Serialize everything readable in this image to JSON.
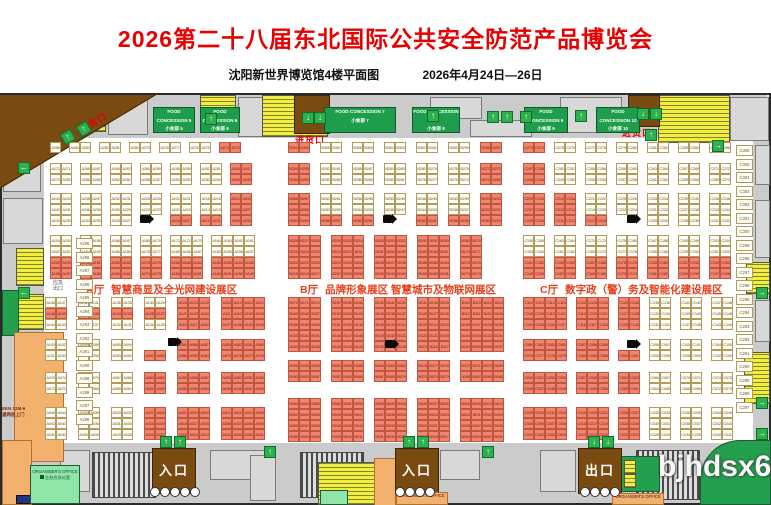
{
  "header": {
    "title": "2026第二十八届东北国际公共安全防范产品博览会",
    "venue": "沈阳新世界博览馆4楼平面图",
    "dates": "2026年4月24日—26日"
  },
  "watermark": "bjhdsx6.c",
  "zones": [
    {
      "label": "A厅",
      "name": "智慧商显及全光网建设展区"
    },
    {
      "label": "B厅",
      "name": "品牌形象展区  智慧城市及物联网展区"
    },
    {
      "label": "C厅",
      "name": "数字政（警）务及智能化建设展区"
    }
  ],
  "labels": {
    "delivery": "进货口",
    "entrance": "入口",
    "exit": "出口",
    "emergency": "应急\n出口",
    "office_en": "ORGANISER'S OFFICE",
    "office_cn": "主办方办公室",
    "left_note": "EEN 12M-6\n通两层上门"
  },
  "food_concessions": [
    {
      "en": "FOOD CONCESSION 5",
      "cn": "小食部 5"
    },
    {
      "en": "FOOD CONCESSION 6",
      "cn": "小食部 6"
    },
    {
      "en": "FOOD CONCESSION 7",
      "cn": "小食部 7"
    },
    {
      "en": "FOOD CONCESSION 8",
      "cn": "小食部 8"
    },
    {
      "en": "FOOD CONCESSION 9",
      "cn": "小食部 9"
    },
    {
      "en": "FOOD CONCESSION 10",
      "cn": "小食部 10"
    }
  ],
  "colors": {
    "pink": "#F08570",
    "cell": "#FFFEF6",
    "zone": "#E8401C",
    "title": "#E60000",
    "dock": "#7A4B10",
    "green": "#1E9E4C",
    "yellow": "#F2EE3E",
    "corridor": "#CBCBCB"
  },
  "halls": {
    "A": {
      "prefix": "A",
      "dir": "desc",
      "x": 50,
      "gap": 8,
      "x2": 45,
      "gap2": 11,
      "column": {
        "x": 76,
        "y": 238,
        "start": 299,
        "count": 14
      },
      "bands": [
        {
          "y": 142,
          "rows": 1,
          "lo": true,
          "blocks": [
            {
              "c": 1,
              "s": 285
            },
            {
              "c": 2,
              "s": 284
            },
            {
              "c": 2,
              "s": 282
            },
            {
              "c": 2,
              "s": 280
            },
            {
              "c": 2,
              "s": 278
            },
            {
              "c": 2,
              "s": 276
            },
            {
              "c": 2,
              "s": 274,
              "p": 1
            }
          ]
        },
        {
          "y": 163,
          "rows": 2,
          "lo": true,
          "blocks": [
            {
              "c": 2,
              "s": 272
            },
            {
              "c": 2,
              "s": 268
            },
            {
              "c": 2,
              "s": 264
            },
            {
              "c": 2,
              "s": 260
            },
            {
              "c": 2,
              "s": 256
            },
            {
              "c": 2,
              "s": 252
            },
            {
              "c": 2,
              "s": 248,
              "p": 1
            }
          ]
        },
        {
          "y": 193,
          "rows": 3,
          "lo": true,
          "blocks": [
            {
              "c": 2,
              "s": 244
            },
            {
              "c": 2,
              "s": 238
            },
            {
              "c": 2,
              "s": 232
            },
            {
              "c": 2,
              "s": 226,
              "r": 2
            },
            {
              "c": 2,
              "s": 222,
              "p": 2
            },
            {
              "c": 2,
              "s": 216,
              "p": 2
            },
            {
              "c": 2,
              "s": 210,
              "p": 1
            }
          ]
        },
        {
          "y": 235,
          "rows": 4,
          "lo": true,
          "blocks": [
            {
              "c": 2,
              "s": 204,
              "p": 2
            },
            {
              "c": 2,
              "s": 196,
              "p": 2
            },
            {
              "c": 2,
              "s": 188,
              "p": 2
            },
            {
              "c": 2,
              "s": 180,
              "p": 2
            },
            {
              "c": 3,
              "s": 172,
              "p": 2
            },
            {
              "c": 4,
              "s": 164,
              "p": 2
            }
          ]
        },
        {
          "y": 297,
          "rows": 3,
          "blocks": [
            {
              "c": 2,
              "s": 148,
              "p": 3
            },
            {
              "c": 2,
              "s": 142,
              "p": 3
            },
            {
              "c": 2,
              "s": 136,
              "p": 3
            },
            {
              "c": 2,
              "s": 130,
              "p": 3
            },
            {
              "c": 3,
              "s": 124,
              "p": 1
            },
            {
              "c": 4,
              "s": 115,
              "p": 1
            }
          ]
        },
        {
          "y": 339,
          "rows": 2,
          "blocks": [
            {
              "c": 2,
              "s": 103
            },
            {
              "c": 2,
              "s": 99
            },
            {
              "c": 2,
              "s": 95
            },
            {
              "c": 2,
              "s": 91,
              "p": 1,
              "r": 1,
              "va": "b"
            },
            {
              "c": 3,
              "s": 89,
              "p": 1
            },
            {
              "c": 4,
              "s": 83,
              "p": 1
            }
          ]
        },
        {
          "y": 372,
          "rows": 2,
          "blocks": [
            {
              "c": 2,
              "s": 75
            },
            {
              "c": 2,
              "s": 71
            },
            {
              "c": 2,
              "s": 67
            },
            {
              "c": 2,
              "s": 63,
              "p": 1
            },
            {
              "c": 3,
              "s": 59,
              "p": 1
            },
            {
              "c": 4,
              "s": 53,
              "p": 1
            }
          ]
        },
        {
          "y": 407,
          "rows": 3,
          "blocks": [
            {
              "c": 2,
              "s": 45
            },
            {
              "c": 2,
              "s": 39
            },
            {
              "c": 2,
              "s": 33
            },
            {
              "c": 2,
              "s": 27,
              "p": 1
            },
            {
              "c": 3,
              "s": 21,
              "p": 1
            },
            {
              "c": 4,
              "s": 12,
              "p": 1
            }
          ]
        }
      ]
    },
    "B": {
      "prefix": "B",
      "dir": "desc",
      "x": 288,
      "gap": 10,
      "x2": 288,
      "gap2": 10,
      "bands": [
        {
          "y": 142,
          "rows": 1,
          "lo": true,
          "blocks": [
            {
              "c": 2,
              "s": 310,
              "p": 1
            },
            {
              "c": 2,
              "s": 308
            },
            {
              "c": 2,
              "s": 306
            },
            {
              "c": 2,
              "s": 304
            },
            {
              "c": 2,
              "s": 302
            },
            {
              "c": 2,
              "s": 300
            },
            {
              "c": 2,
              "s": 298,
              "p": 1
            }
          ]
        },
        {
          "y": 163,
          "rows": 2,
          "lo": true,
          "blocks": [
            {
              "c": 2,
              "s": 296,
              "p": 1
            },
            {
              "c": 2,
              "s": 292
            },
            {
              "c": 2,
              "s": 288
            },
            {
              "c": 2,
              "s": 284
            },
            {
              "c": 2,
              "s": 280
            },
            {
              "c": 2,
              "s": 276
            },
            {
              "c": 2,
              "s": 272,
              "p": 1
            }
          ]
        },
        {
          "y": 193,
          "rows": 3,
          "lo": true,
          "blocks": [
            {
              "c": 2,
              "s": 268,
              "p": 1
            },
            {
              "c": 2,
              "s": 262,
              "p": 2
            },
            {
              "c": 2,
              "s": 256,
              "p": 2
            },
            {
              "c": 2,
              "s": 250,
              "r": 2
            },
            {
              "c": 2,
              "s": 246,
              "p": 2
            },
            {
              "c": 2,
              "s": 240,
              "p": 2
            },
            {
              "c": 2,
              "s": 234,
              "p": 1
            }
          ]
        },
        {
          "y": 235,
          "rows": 4,
          "lo": true,
          "blocks": [
            {
              "c": 3,
              "s": 228,
              "p": 1
            },
            {
              "c": 3,
              "s": 216,
              "p": 1
            },
            {
              "c": 3,
              "s": 204,
              "p": 1
            },
            {
              "c": 3,
              "s": 192,
              "p": 1
            },
            {
              "c": 2,
              "s": 180,
              "p": 1
            }
          ]
        },
        {
          "y": 297,
          "rows": 5,
          "blocks": [
            {
              "c": 3,
              "s": 172,
              "p": 1
            },
            {
              "c": 3,
              "s": 157,
              "p": 1
            },
            {
              "c": 3,
              "s": 142,
              "p": 1
            },
            {
              "c": 3,
              "s": 131,
              "p": 1
            },
            {
              "c": 4,
              "s": 116,
              "p": 1
            }
          ]
        },
        {
          "y": 360,
          "rows": 2,
          "blocks": [
            {
              "c": 3,
              "s": 96,
              "p": 1
            },
            {
              "c": 3,
              "s": 90,
              "p": 1
            },
            {
              "c": 3,
              "s": 84,
              "p": 1
            },
            {
              "c": 3,
              "s": 78,
              "p": 1
            },
            {
              "c": 4,
              "s": 72,
              "p": 1
            }
          ]
        },
        {
          "y": 398,
          "rows": 4,
          "blocks": [
            {
              "c": 3,
              "s": 64,
              "p": 1
            },
            {
              "c": 3,
              "s": 52,
              "p": 1
            },
            {
              "c": 3,
              "s": 40,
              "p": 1
            },
            {
              "c": 3,
              "s": 28,
              "p": 1
            },
            {
              "c": 4,
              "s": 16,
              "p": 1
            }
          ]
        }
      ]
    },
    "C": {
      "prefix": "C",
      "dir": "asc",
      "x": 523,
      "gap": 9,
      "x2": 523,
      "gap2": 9,
      "column": {
        "x": 736,
        "y": 145,
        "start": 306,
        "count": 20
      },
      "bands": [
        {
          "y": 142,
          "rows": 1,
          "lo": true,
          "blocks": [
            {
              "c": 2,
              "s": 273,
              "p": 1
            },
            {
              "c": 2,
              "s": 275
            },
            {
              "c": 2,
              "s": 277
            },
            {
              "c": 2,
              "s": 279
            },
            {
              "c": 2,
              "s": 281
            },
            {
              "c": 2,
              "s": 283
            },
            {
              "c": 2,
              "s": 285
            }
          ]
        },
        {
          "y": 163,
          "rows": 2,
          "lo": true,
          "blocks": [
            {
              "c": 2,
              "s": 245,
              "p": 1
            },
            {
              "c": 2,
              "s": 249
            },
            {
              "c": 2,
              "s": 253
            },
            {
              "c": 2,
              "s": 257
            },
            {
              "c": 2,
              "s": 261
            },
            {
              "c": 2,
              "s": 265
            },
            {
              "c": 2,
              "s": 269
            }
          ]
        },
        {
          "y": 193,
          "rows": 3,
          "lo": true,
          "blocks": [
            {
              "c": 2,
              "s": 205,
              "p": 1
            },
            {
              "c": 2,
              "s": 211,
              "p": 1
            },
            {
              "c": 2,
              "s": 217,
              "p": 2
            },
            {
              "c": 2,
              "s": 223,
              "r": 2
            },
            {
              "c": 2,
              "s": 229
            },
            {
              "c": 2,
              "s": 235
            },
            {
              "c": 2,
              "s": 241
            }
          ]
        },
        {
          "y": 235,
          "rows": 4,
          "lo": true,
          "blocks": [
            {
              "c": 2,
              "s": 149,
              "p": 2
            },
            {
              "c": 2,
              "s": 157,
              "p": 2
            },
            {
              "c": 2,
              "s": 165,
              "p": 2
            },
            {
              "c": 2,
              "s": 173,
              "p": 2
            },
            {
              "c": 2,
              "s": 181,
              "p": 2
            },
            {
              "c": 2,
              "s": 189,
              "p": 2
            },
            {
              "c": 2,
              "s": 197,
              "p": 2
            }
          ]
        },
        {
          "y": 297,
          "rows": 3,
          "blocks": [
            {
              "c": 4,
              "s": 104,
              "p": 1
            },
            {
              "c": 3,
              "s": 116,
              "p": 1
            },
            {
              "c": 2,
              "s": 125,
              "p": 1
            },
            {
              "c": 2,
              "s": 131
            },
            {
              "c": 2,
              "s": 137
            },
            {
              "c": 2,
              "s": 143
            }
          ]
        },
        {
          "y": 339,
          "rows": 2,
          "blocks": [
            {
              "c": 4,
              "s": 76,
              "p": 1
            },
            {
              "c": 3,
              "s": 84,
              "p": 1
            },
            {
              "c": 2,
              "s": 90,
              "p": 1,
              "r": 1,
              "va": "b"
            },
            {
              "c": 2,
              "s": 94
            },
            {
              "c": 2,
              "s": 98
            },
            {
              "c": 2,
              "s": 102
            }
          ]
        },
        {
          "y": 372,
          "rows": 2,
          "blocks": [
            {
              "c": 4,
              "s": 46,
              "p": 1
            },
            {
              "c": 3,
              "s": 54,
              "p": 1
            },
            {
              "c": 2,
              "s": 60,
              "p": 1
            },
            {
              "c": 2,
              "s": 64
            },
            {
              "c": 2,
              "s": 68
            },
            {
              "c": 2,
              "s": 72
            }
          ]
        },
        {
          "y": 407,
          "rows": 3,
          "blocks": [
            {
              "c": 4,
              "s": 1,
              "p": 1
            },
            {
              "c": 3,
              "s": 13,
              "p": 1
            },
            {
              "c": 2,
              "s": 22,
              "p": 1
            },
            {
              "c": 2,
              "s": 28
            },
            {
              "c": 2,
              "s": 34
            },
            {
              "c": 2,
              "s": 40
            }
          ]
        }
      ]
    }
  }
}
